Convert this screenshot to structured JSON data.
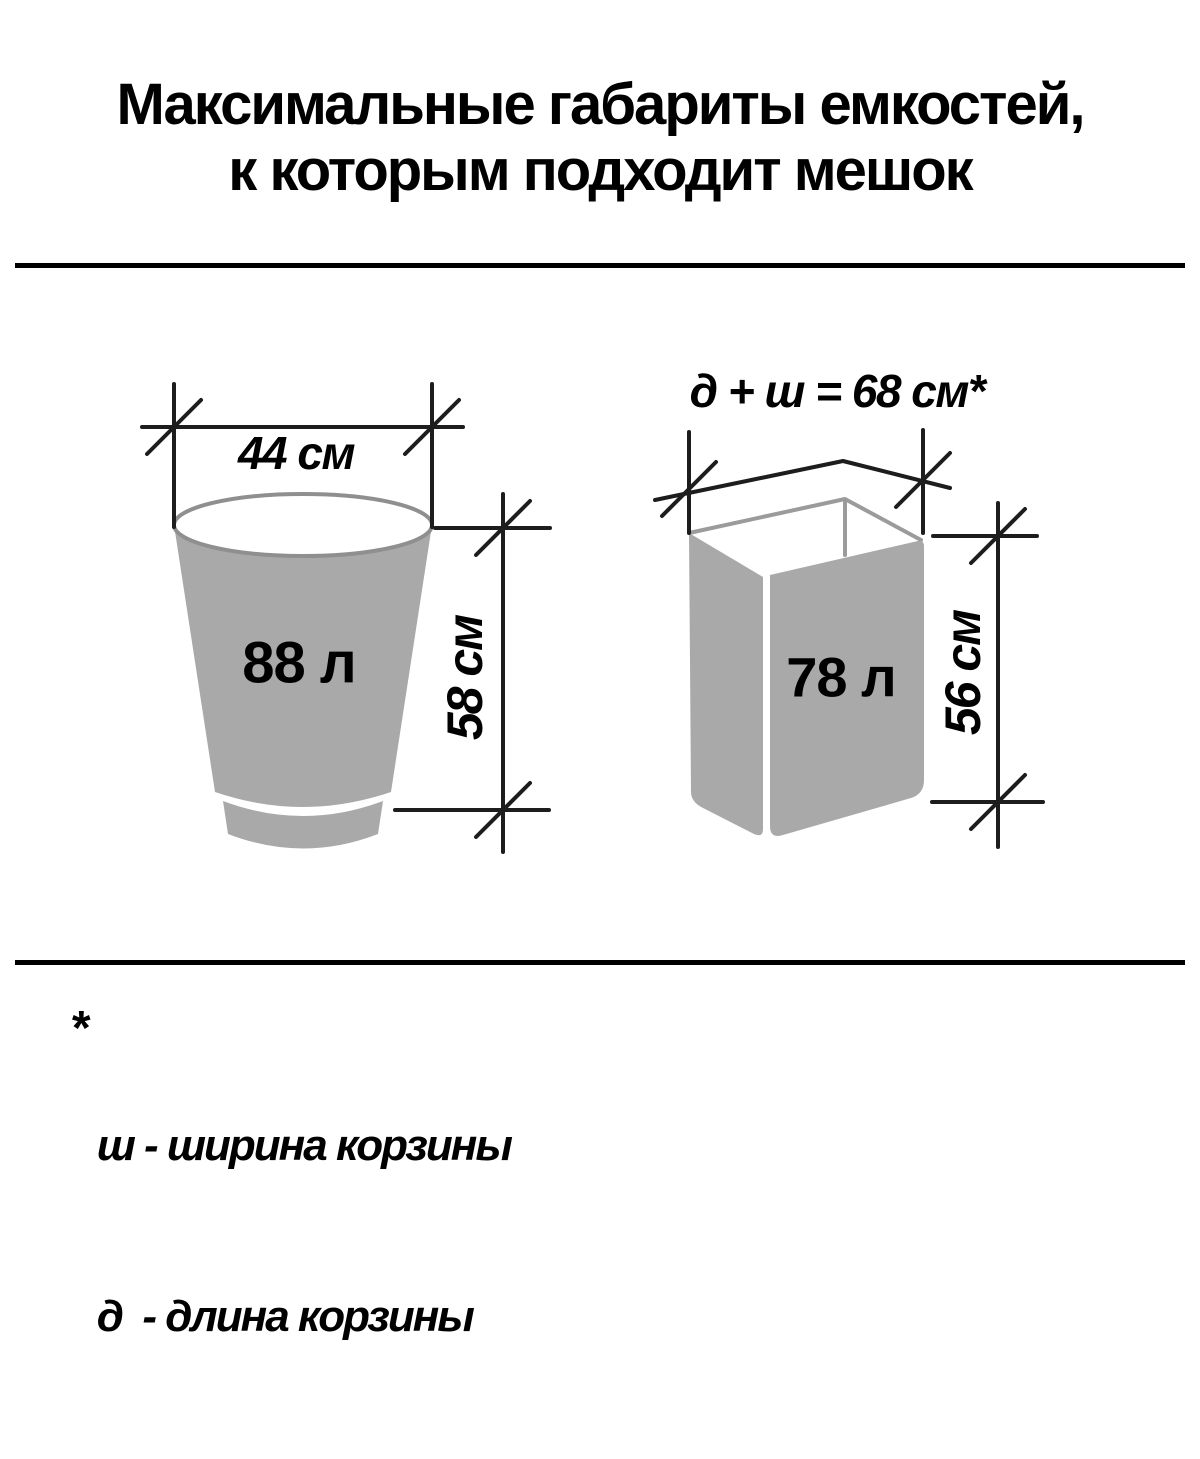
{
  "title": {
    "line1": "Максимальные габариты емкостей,",
    "line2": "к которым подходит мешок"
  },
  "left_container": {
    "width_label": "44 см",
    "volume_label": "88 л",
    "height_label": "58 см"
  },
  "right_container": {
    "dimensions_label": "д + ш = 68 см*",
    "volume_label": "78 л",
    "height_label": "56 см"
  },
  "footnote": {
    "marker": "*",
    "lines": [
      "ш - ширина корзины",
      "д  - длина корзины"
    ]
  },
  "colors": {
    "background": "#ffffff",
    "text": "#000000",
    "dimension_line": "#1d1d1d",
    "container_fill": "#a9a9a9",
    "container_outline": "#8f8f8f",
    "box_rim_line": "#9b9b9b"
  }
}
